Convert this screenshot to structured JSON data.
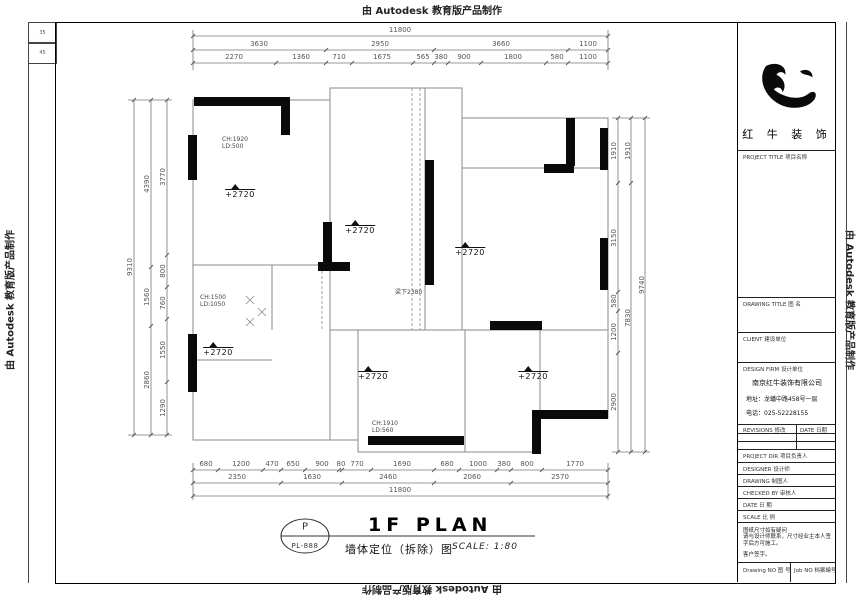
{
  "banners": {
    "top": "由 Autodesk 教育版产品制作",
    "bottom": "由 Autodesk 教育版产品制作",
    "left": "由 Autodesk 教育版产品制作",
    "right": "由 Autodesk 教育版产品制作"
  },
  "margin_marks": {
    "a": "35",
    "b": "45"
  },
  "title_block": {
    "brand": {
      "logo": "bull-icon",
      "name": "红 牛 装 饰"
    },
    "project_title_label": "PROJECT TITLE  项目名称",
    "drawing_title_label": "DRAWING TITLE  图 名",
    "client_label": "CLIENT  建设单位",
    "design_firm_label": "DESIGN FIRM  设计单位",
    "company": {
      "name": "南京红牛装饰有限公司",
      "address": "地址：龙蟠中路458号一层",
      "phone": "电话：025-52228155"
    },
    "revisions_label": "REVISIONS  修改",
    "rev_date_label": "DATE  日期",
    "fields": [
      {
        "label": "PROJECT DIR  项目负责人"
      },
      {
        "label": "DESIGNER  设计师"
      },
      {
        "label": "DRAWING  制图人"
      },
      {
        "label": "CHECKED BY  审核人"
      },
      {
        "label": "DATE  日 期"
      },
      {
        "label": "SCALE  比 例"
      }
    ],
    "note": {
      "line1": "图纸尺寸如有疑问",
      "line2": "请与设计师联系，尺寸经业主本人签字后方可施工。",
      "line3": "客户签字。"
    },
    "drawing_no_label": "Drawing NO  图 号",
    "job_no_label": "Job NO  档案编号"
  },
  "plan": {
    "levels": [
      {
        "label": "+2720"
      },
      {
        "label": "+2720"
      },
      {
        "label": "+2720"
      },
      {
        "label": "+2720"
      },
      {
        "label": "+2720"
      },
      {
        "label": "+2720"
      }
    ],
    "annotations": [
      {
        "l1": "CH:1920",
        "l2": "LD:500"
      },
      {
        "l1": "CH:1500",
        "l2": "LD:1050"
      },
      {
        "l1": "CH:1910",
        "l2": "LD:560"
      }
    ],
    "beam_note": "梁下2380"
  },
  "dims": {
    "top": {
      "overall": "11800",
      "row2": [
        "3630",
        "2950",
        "3660",
        "1100"
      ],
      "row3": [
        "2270",
        "1360",
        "710",
        "1675",
        "565",
        "380",
        "900",
        "1800",
        "580",
        "1100"
      ]
    },
    "bottom": {
      "row1": [
        "680",
        "1200",
        "470",
        "650",
        "900",
        "80",
        "770",
        "1690",
        "680",
        "1000",
        "380",
        "800",
        "1770"
      ],
      "row2": [
        "2350",
        "1630",
        "2460",
        "2060",
        "2570"
      ],
      "overall": "11800"
    },
    "left": {
      "overall": "9310",
      "mid": [
        "4390",
        "1560",
        "2860"
      ],
      "inner": [
        "3770",
        "800",
        "760",
        "1550",
        "1290"
      ]
    },
    "right": {
      "inner": [
        "1910",
        "3150",
        "580",
        "1200",
        "2900"
      ],
      "mid": [
        "1910",
        "7830"
      ],
      "overall": "9740"
    }
  },
  "footer": {
    "stamp_letter": "P",
    "stamp_no": "PL-888",
    "title": "1F PLAN",
    "subtitle": "墙体定位（拆除）图",
    "scale": "SCALE: 1:80"
  }
}
